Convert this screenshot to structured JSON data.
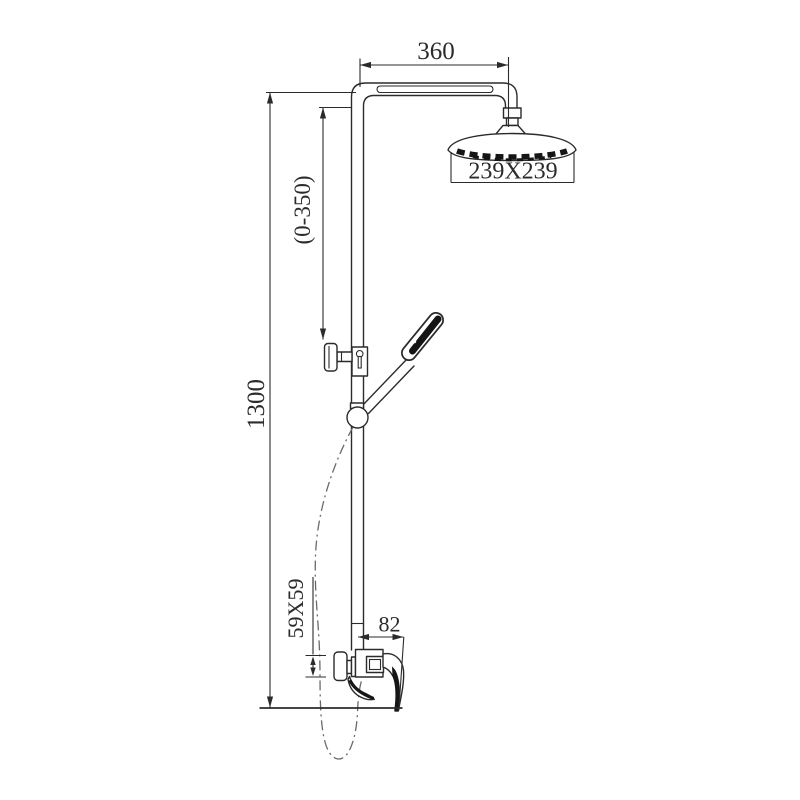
{
  "drawing": {
    "subject": "Exposed shower column set - dimensional line drawing",
    "view": "side elevation",
    "background_color": "#ffffff",
    "line_color": "#2b2b2b",
    "labels": {
      "arm_length": "360",
      "head_size": "239X239",
      "slider_range": "(0-350)",
      "total_height": "1300",
      "escutcheon_size": "59X59",
      "mixer_depth": "82"
    },
    "components": {
      "shower_arm": "shower arm tube",
      "overhead_shower": "overhead rain shower head",
      "riser_rail": "vertical riser rail",
      "slider": "slider bracket with locking knob",
      "hand_shower": "hand shower resting in holder",
      "hose": "shower hose (dash-dot line)",
      "mixer": "wall-mounted mixer valve with lever handle",
      "escutcheon": "wall escutcheon plate"
    }
  }
}
